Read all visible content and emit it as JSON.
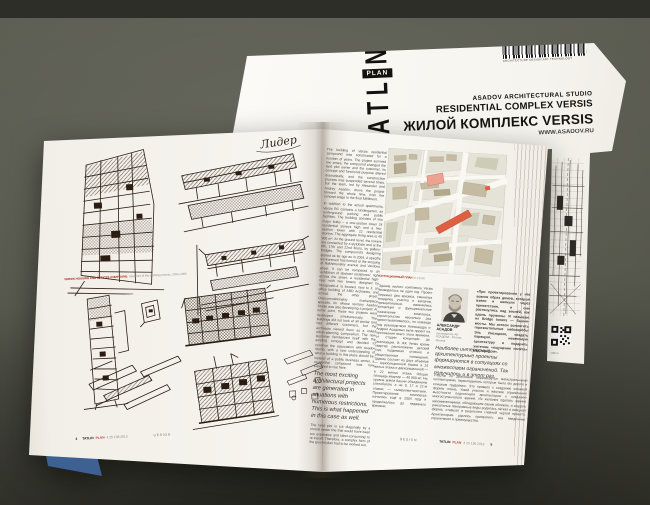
{
  "photo": {
    "background_color": "#55564c",
    "page_color": "#f8f6f1",
    "ink_color": "#2b1d12",
    "accent_red": "#b5443c"
  },
  "cover_magazine": {
    "logo_letters_bottom_to_top": "TATL",
    "logo_letter_top": "N",
    "logo_plan_label": "PLAN",
    "barcode_caption": "ARCHITECTURE DESIGN ART TECHNOLOGY",
    "studio_line": "ASADOV ARCHITECTURAL STUDIO",
    "title_en": "RESIDENTIAL COMPLEX VERSIS",
    "title_ru": "ЖИЛОЙ КОМПЛЕКС VERSIS",
    "subtitle_partial": "WWW.ASADOV.RU",
    "qr_caption": "tatlin.ru"
  },
  "left_page": {
    "handwritten_note": "Лидер",
    "caption_red": "VERSIS HOUSING AND OFFICES COMPOUND.",
    "caption_gray": " Sketches of the working process, 2004–2006",
    "page_number": "4"
  },
  "right_page": {
    "english_column": {
      "p1": "The building of Versis residential compound was constructed for a number of years. The project survived two crises, the compound changed the land plot owner and the customer, its concept and functional purpose altered dramatically, and the construction process was suspended several times, but the team, led by Alexander and Andrey Asadov, drove the project forward the whole time, from the concept stage to the final fulfillment.",
      "p2": "In addition to the actual apartments, Versis RC contains a kindergarten, an underground parking and public facilities. The building consists of two major bulks – a one-section tower 24 residential storeys high and a two-section tower with 22 residential storeys. The aggregate living area is 40 900 m². At the ground level, the towers are connected by a stylobate and at the 9th, 17th and 22nd floors, by gallery-bridges. The compound's designing started as far ago as in 2004. A specific environment has formed at the crossing of Nakhimovskiy avenue and Vavilova street. It can be compared to an 'exhibition of abstract sculptures': right across the street, a residential high-riser with two towers designed by 'Mosproekt-4' is located, next to it, an office building of ABD Architects, and across the other street, Cheryomushkinskiy marketplace spreads, for whose territory Asadov Studio was also developing a project. At some point, these two projects were developed simultaneously. The buildings did not look at all similar and had different customers, but the architects viewed them as a united urban-planning composition. The new customer familiarized itself with the existing concept and decided to continue the association with Asadov Studio, with a new understanding of what a building in this place should be: instead of a public business center, a residential compound was now expected to rise here.",
      "pull_quote": "The most exciting architectural projects are generated in situations with numerous restrictions. This is what happened in this case as well.",
      "p3": "The land plot is cut diagonally by a crucial sewer line that would have been too expensive and labor-consuming to re-install. Therefore, a complex form of the ground plan had to be worked out."
    },
    "map_caption_label": "СИТУАЦИОННЫЙ ПЛАН",
    "map_caption_scale": " М 1:2000",
    "russian_intro": "Здание жилого комплекса Versis возводилось не один год. Проект пережил два кризиса, сменился владелец участка и заказчик, принципиально изменились концепция и функциональное назначение комплекса, строительство несколько раз приостанавливалось, но команда под руководством Александра и Андрея Асадовых вела проект на протяжении всего этого времени, от стадии концепции до реализации. В ЖК Versis кроме квартир расположены детский сад, подземная стоянка и общественные помещения. Здание состоит из двух объёмов — односекционной башни в 24 жилых этажа и двухсекционной — в 22 жилых этажа. Общая площадь квартир — 40 900 м². На уровне земли башни объединены стилобатом, а на 9, 17 и 22-м этажах — галереями-мостами. Проектирование комплекса началось ещё в 2004 году и продолжалось до недавнего времени.",
    "author_name": "АЛЕКСАНДР АСАДОВ",
    "author_role": "руководитель АБ АСАДОВА · Россия, Москва",
    "lead_quote": "«При проектировании у нас возник образ домов, которые взяли и шагнули через препятствия, и они растянулись над землёй, как вдоль пружины. Я называю их Bridge towers — башни-мосты. Мы хотели воплотить горизонтальные небоскрёбы Эль Лисицкого, создать парящую, невесомую архитектуру и подарить жителям «ощущение полёта» над городом».",
    "pull_quote_ru": "Наиболее интересные архитектурные проекты формируются в ситуациях со множеством ограничений. Так получилось и в этот раз.",
    "russian_continuation": "Участок по диагонали пересекается магистральными коллекторами, перекладывать которые было бы дорого и слишком трудоёмко. Это привело к созданию сложной формы плана. Узкий участок и жёсткие ограничения высотности подтолкнули архитекторов к созданию многоступенчатого здания. Из желания сделать здание запоминающимся, обладающим своим обликом, и создать уникальные панорамные виды родилась лёгкая и изящная форма, ставшая в результате главной чертой проекта. Архитекторам удалось превратить все введённые ограничения в преимущества.",
    "page_number": "5"
  },
  "footer": {
    "magazine": "TATLIN",
    "edition": "PLAN",
    "issue_info": "4 25 138 2013",
    "section": "DESIGN"
  }
}
